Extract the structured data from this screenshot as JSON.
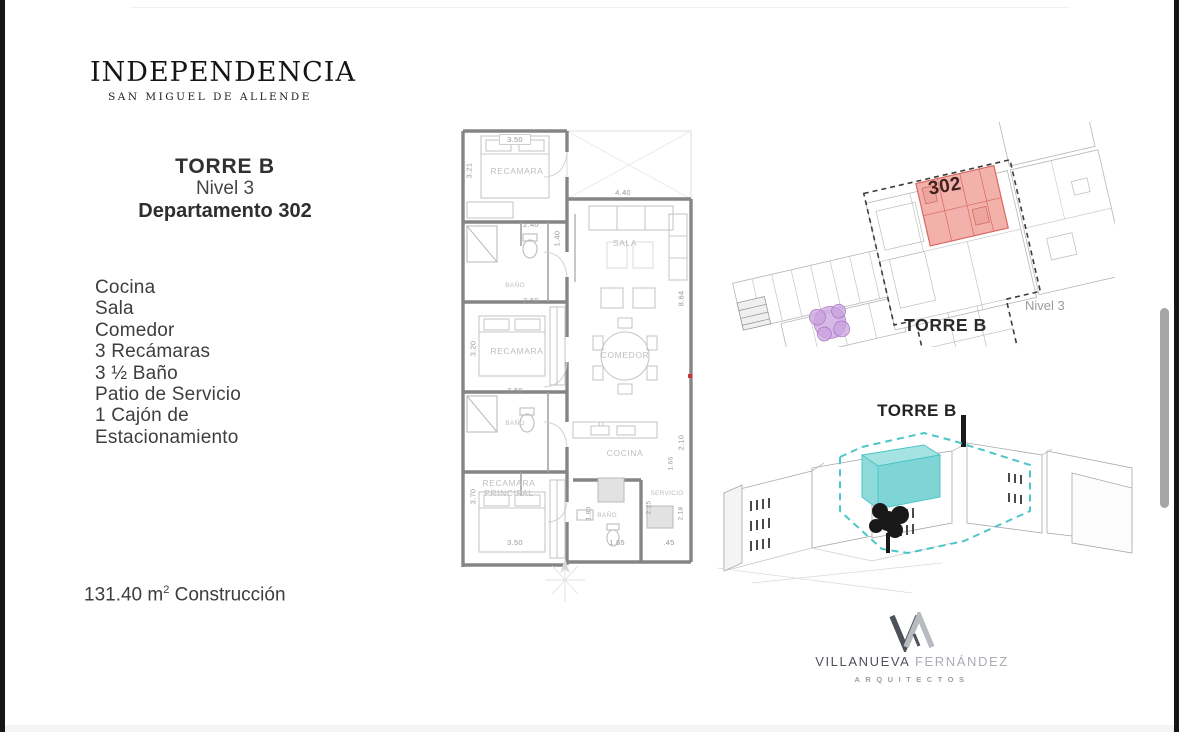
{
  "logo": {
    "title": "Independencia",
    "subtitle": "San Miguel de Allende"
  },
  "header": {
    "tower": "TORRE B",
    "level": "Nivel 3",
    "unit": "Departamento 302"
  },
  "features": {
    "items": [
      "Cocina",
      "Sala",
      "Comedor",
      "3 Recámaras",
      "3 ½ Baño",
      "Patio de Servicio",
      "1 Cajón de",
      "Estacionamiento"
    ]
  },
  "area": {
    "main": "131.40 m",
    "sup": "2",
    "suffix": "Construcción"
  },
  "floor_plan": {
    "rooms": [
      {
        "label": "RECAMARA"
      },
      {
        "label": "BAÑO"
      },
      {
        "label": "SALA"
      },
      {
        "label": "RECAMARA"
      },
      {
        "label": "COMEDOR"
      },
      {
        "label": "BAÑO"
      },
      {
        "label": "RECAMARA"
      },
      {
        "label": "PRINCIPAL"
      },
      {
        "label": "COCINA"
      },
      {
        "label": "BAÑO"
      },
      {
        "label": "SERVICIO"
      }
    ],
    "dimensions": [
      {
        "value": "3.50"
      },
      {
        "value": "3.21"
      },
      {
        "value": "2.40"
      },
      {
        "value": "2.50"
      },
      {
        "value": "1.40"
      },
      {
        "value": "4.40"
      },
      {
        "value": "3.20"
      },
      {
        "value": "3.50"
      },
      {
        "value": "8.64"
      },
      {
        "value": "3.70"
      },
      {
        "value": "3.50"
      },
      {
        "value": "2.10"
      },
      {
        "value": "1.66"
      },
      {
        "value": "2.25"
      },
      {
        "value": "2.18"
      },
      {
        "value": "1.80"
      },
      {
        "value": "1.65"
      },
      {
        "value": ".45"
      }
    ]
  },
  "site_plan": {
    "unit_number": "302",
    "tower_label": "TORRE B",
    "level_label": "Nivel 3",
    "colors": {
      "unit_fill": "#f2b1ab",
      "unit_stroke": "#d9675e",
      "unit_text": "#40221e",
      "tree": "#c9a2de"
    }
  },
  "axon": {
    "tower_label": "TORRE B",
    "colors": {
      "highlight_fill": "#8edada",
      "highlight_stroke": "#4cc6c8"
    }
  },
  "firm": {
    "name_primary": "VILLANUEVA",
    "name_secondary": "FERNÁNDEZ",
    "tagline": "ARQUITECTOS"
  }
}
